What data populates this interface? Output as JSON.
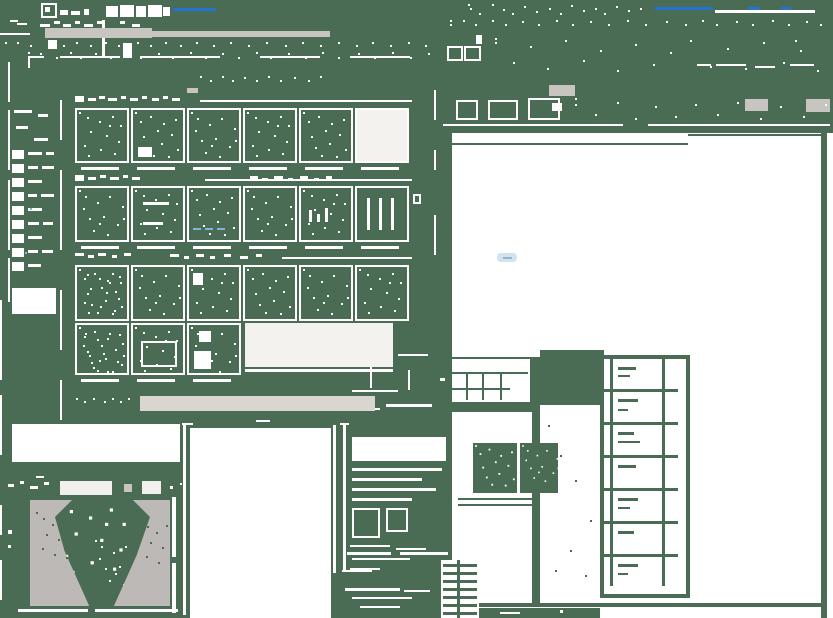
{
  "screen": {
    "width": 833,
    "height": 618,
    "background_color": "#4b6c54"
  },
  "colors": {
    "fragment_white": "#ffffff",
    "toolbar_gray": "#c8c4c0",
    "dropdown_bar_gray": "#d9d5d1",
    "preview_shape_gray": "#bcb9b6",
    "titlebar_accent_blue": "#2273d4",
    "cyan_speck": "#7fb7dc",
    "canvas_white": "#ffffff",
    "swatch_fill_white": "#f4f2ef"
  },
  "regions": {
    "titlebar": "application title bar",
    "menubar": "menu bar",
    "toolbar": "toolbar",
    "dialog": "pattern palette dialog",
    "left_panel": "tool palette list",
    "canvas": "drawing canvas",
    "preview_window": "pattern preview window",
    "schedule_table": "drawing schedule table",
    "stairs": "stair detail drawing"
  },
  "titlebar": {
    "blue_segment_count": 4
  },
  "dialog": {
    "section_count": 3,
    "swatch_rows": [
      6,
      6,
      6,
      3
    ],
    "solid_swatch_row": 1,
    "has_wide_preview_box": true,
    "has_bottom_dropdown_bar": true
  },
  "left_panel": {
    "list_row_count": 9,
    "has_bottom_swatch": true
  },
  "canvas": {
    "schedule_row_count": 7,
    "has_cyan_marker": true
  },
  "preview_window": {
    "toolbar_button_count": 2
  }
}
